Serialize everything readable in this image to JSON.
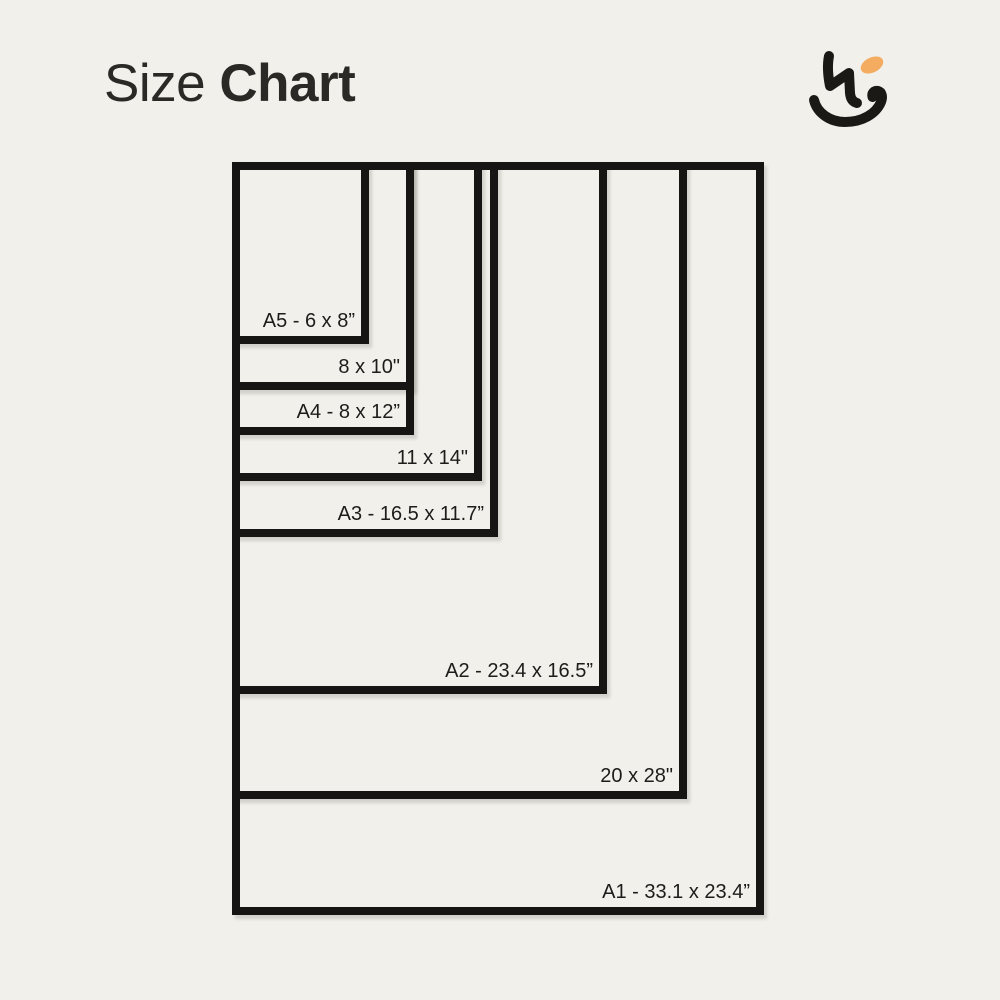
{
  "canvas": {
    "background": "#F2F0EB"
  },
  "header": {
    "title_regular": "Size",
    "title_bold": "Chart",
    "title_color": "#2A2926"
  },
  "logo": {
    "name": "brand-monogram",
    "ink_color": "#1A1916",
    "accent_color": "#F3AC60"
  },
  "chart_data": {
    "type": "table",
    "title": "Size Chart",
    "unit": "inches",
    "layout_hint": "nested rectangles sharing top-left corner, label inside bottom-right of each rectangle",
    "border_color": "#161513",
    "label_color": "#1D1C1A",
    "sizes": [
      {
        "name": "A5",
        "label": "A5 - 6 x 8”",
        "width_in": 6,
        "height_in": 8
      },
      {
        "name": "8x10",
        "label": "8 x 10\"",
        "width_in": 8,
        "height_in": 10
      },
      {
        "name": "A4",
        "label": "A4 - 8 x 12”",
        "width_in": 8,
        "height_in": 12
      },
      {
        "name": "11x14",
        "label": "11 x 14\"",
        "width_in": 11,
        "height_in": 14
      },
      {
        "name": "A3",
        "label": "A3 - 16.5 x 11.7”",
        "width_in": 11.7,
        "height_in": 16.5
      },
      {
        "name": "A2",
        "label": "A2 - 23.4 x 16.5”",
        "width_in": 16.5,
        "height_in": 23.4
      },
      {
        "name": "20x28",
        "label": "20 x 28\"",
        "width_in": 20,
        "height_in": 28
      },
      {
        "name": "A1",
        "label": "A1 - 33.1 x 23.4”",
        "width_in": 23.4,
        "height_in": 33.1
      }
    ]
  }
}
